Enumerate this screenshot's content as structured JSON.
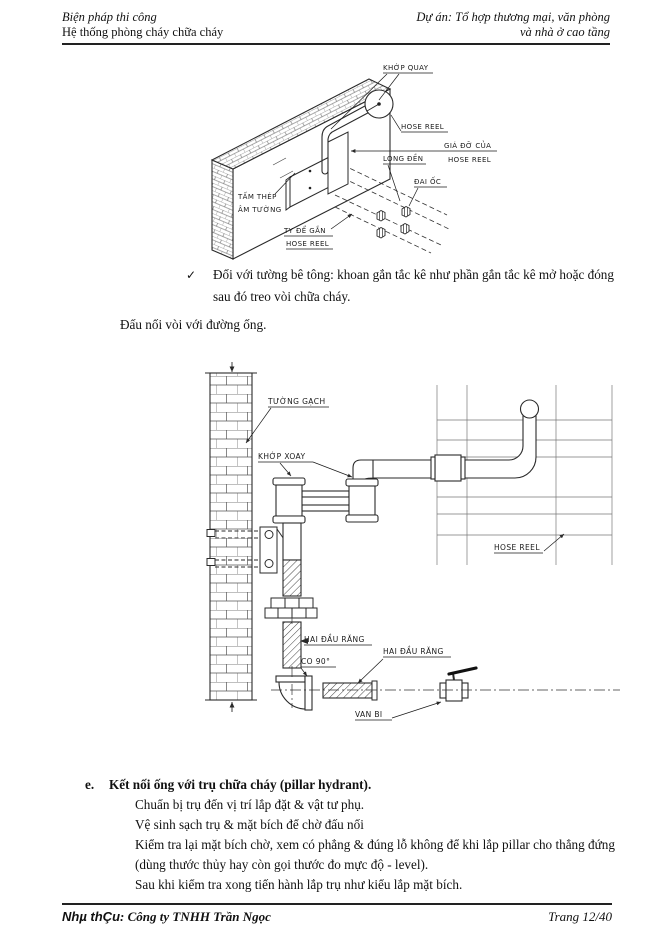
{
  "header": {
    "left_line1": "Biện pháp thi công",
    "left_line2": "Hệ thống phòng cháy chữa cháy",
    "right_line1": "Dự án: Tổ hợp thương mại, văn phòng",
    "right_line2": "và nhà ở cao tầng"
  },
  "diagram1": {
    "labels": {
      "khop_quay": "KHỚP QUAY",
      "hose_reel": "HOSE REEL",
      "gia_do_line1": "GIÁ ĐỠ CỦA",
      "gia_do_line2": "HOSE REEL",
      "long_den": "LONG ĐỀN",
      "dai_oc": "ĐAI ỐC",
      "tam_thep_line1": "TẤM THÉP",
      "tam_thep_line2": "ÂM TƯỜNG",
      "ty_de_gan_line1": "TY ĐỂ GẮN",
      "ty_de_gan_line2": "HOSE REEL"
    }
  },
  "body": {
    "check_mark": "✓",
    "check_bullet": "Đối với tường bê tông: khoan gắn tắc kê như phần gắn tắc kê mở hoặc đóng sau đó treo vòi chữa cháy.",
    "para_connect": "Đấu nối vòi với đường ống."
  },
  "diagram2": {
    "labels": {
      "tuong_gach": "TƯỜNG GẠCH",
      "khop_xoay": "KHỚP XOAY",
      "hose_reel": "HOSE REEL",
      "hai_dau_rang_1": "HAI ĐẦU RĂNG",
      "co_90": "CO 90°",
      "hai_dau_rang_2": "HAI ĐẦU RĂNG",
      "van_bi": "VAN BI"
    }
  },
  "section_e": {
    "marker": "e.",
    "heading": "Kết nối ống với trụ chữa cháy (pillar hydrant).",
    "lines": [
      "Chuẩn bị trụ đến vị trí lắp đặt & vật tư phụ.",
      "Vệ sinh sạch trụ & mặt bích để chờ đấu nối",
      "Kiểm tra lại mặt bích chờ, xem có phẳng & đúng lỗ không để khi lắp pillar cho thẳng đứng",
      "(dùng thước thủy hay còn gọi thước đo mực độ - level).",
      "Sau khi kiểm tra xong tiến hành lắp trụ như kiểu lắp mặt bích."
    ]
  },
  "footer": {
    "contractor_label": "Nhµ thÇu",
    "contractor_value": ": Công ty TNHH Trần Ngọc",
    "page": "Trang 12/40"
  },
  "colors": {
    "ink": "#111111",
    "line": "#2a2a2a",
    "paper": "#ffffff"
  }
}
